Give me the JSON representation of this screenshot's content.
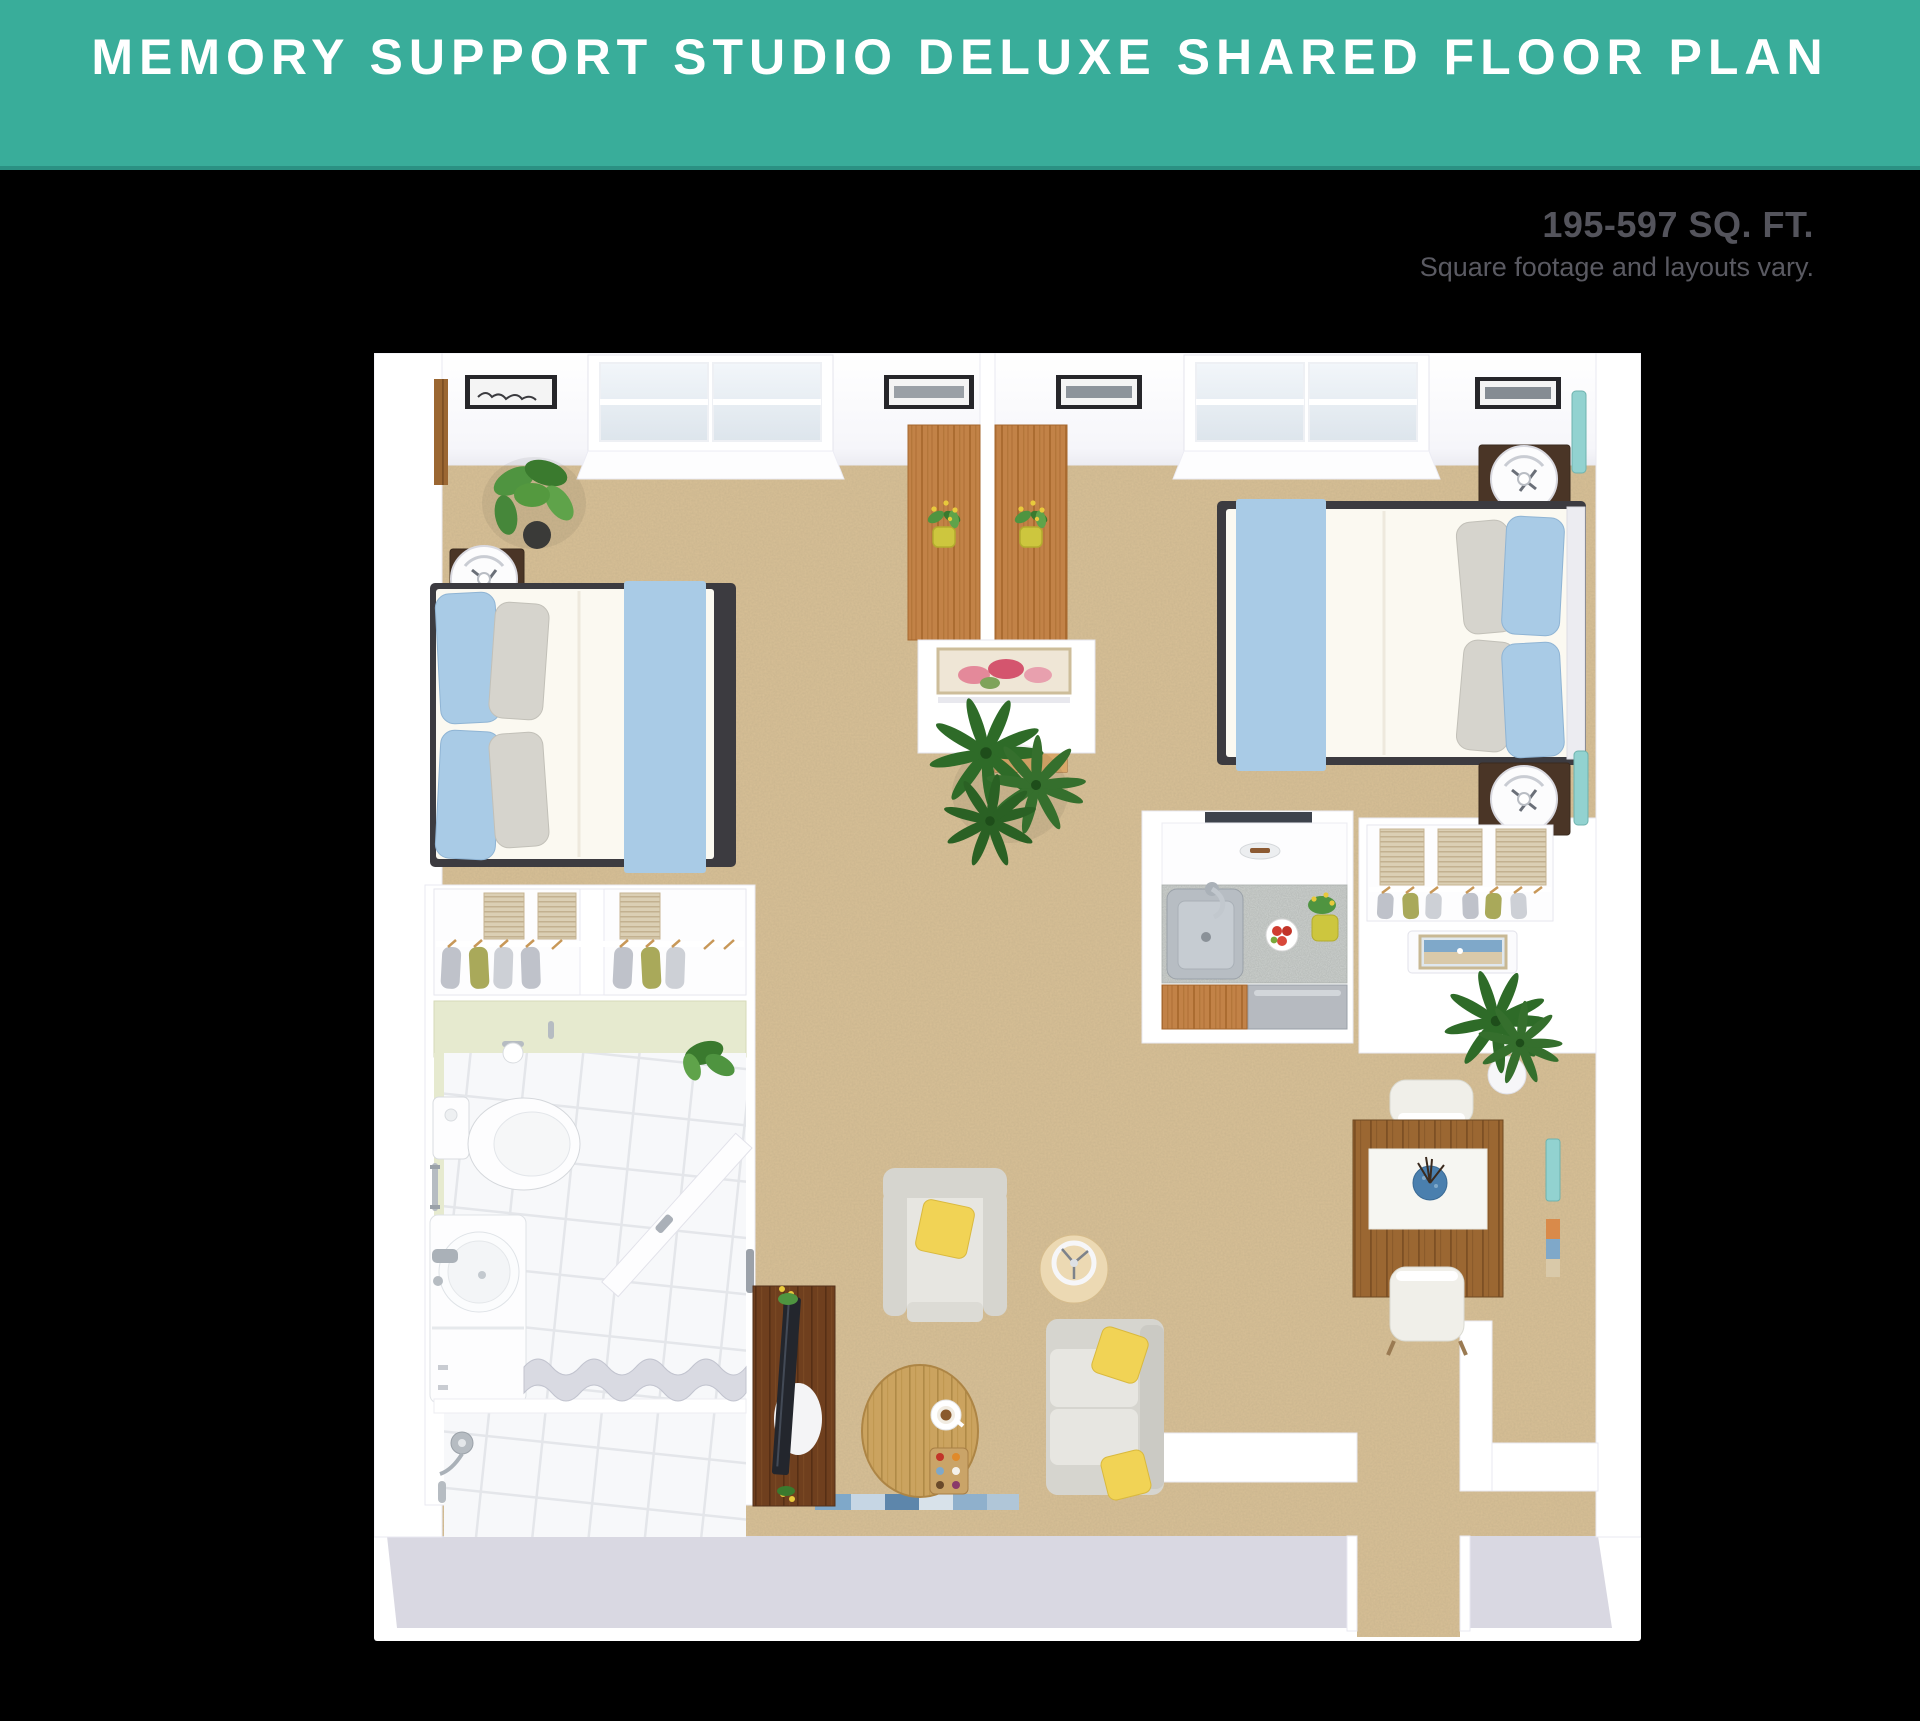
{
  "header": {
    "title": "MEMORY SUPPORT STUDIO DELUXE SHARED FLOOR PLAN"
  },
  "details": {
    "square_footage": "195-597 SQ. FT.",
    "disclaimer": "Square footage and layouts vary."
  },
  "floor_plan": {
    "alt": "3D top-down floor plan rendering of a shared memory support studio deluxe apartment",
    "rooms": [
      "shared sleeping area with two beds",
      "kitchenette",
      "two wardrobe closets",
      "bathroom",
      "living area",
      "dining area",
      "entry hall"
    ],
    "furniture": [
      "two beds with light blue runners and pillows",
      "three nightstands with round white lamps",
      "two back-to-back wood desks with flower pots",
      "room divider console with pink floral artwork",
      "kitchenette counter with stainless sink, fruit bowl and flowers",
      "wardrobe closets with hanging clothes and wicker baskets",
      "toilet",
      "round vanity sink",
      "walk-in shower with curtain",
      "armchair with yellow pillow",
      "loveseat sofa with yellow pillows",
      "oval wood coffee table with coffee cup and tray",
      "round side table with ring lamp",
      "dark wood tv console with television and flowers",
      "dining table with white runner, blue vase and two chairs",
      "potted green plants"
    ]
  },
  "colors": {
    "banner": "#39AD9A",
    "banner_edge": "#2B9183",
    "page_background": "#000000",
    "card_background": "#FFFFFF",
    "sqft_text": "#54545C",
    "note_text": "#5A5A62",
    "carpet": "#D8C096",
    "front_wall": "#D9D8E2",
    "accent_blue": "#A9CBE6",
    "accent_yellow": "#F1D355",
    "linen": "#FBF9F1",
    "pillow_gray": "#D6D4CD",
    "bed_frame": "#3C3B40",
    "wood_desk": "#C28247",
    "wood_dining": "#9B6732",
    "wood_dark": "#6F3F1E",
    "wood_light": "#CBA35F",
    "counter": "#CFD3D0",
    "steel": "#B7BDC3",
    "bath_green": "#E6EACF",
    "curtain": "#D9DAE2",
    "sofa": "#D6D5CF",
    "sofa_seat": "#E7E6E1",
    "plant_green": "#4F9440",
    "palm_green": "#2E6B28",
    "olive": "#A9A95A",
    "clothes_gray": "#BFC2CA",
    "teal_glass": "#92D2D0",
    "rug_blue": "#7FA8C9"
  }
}
